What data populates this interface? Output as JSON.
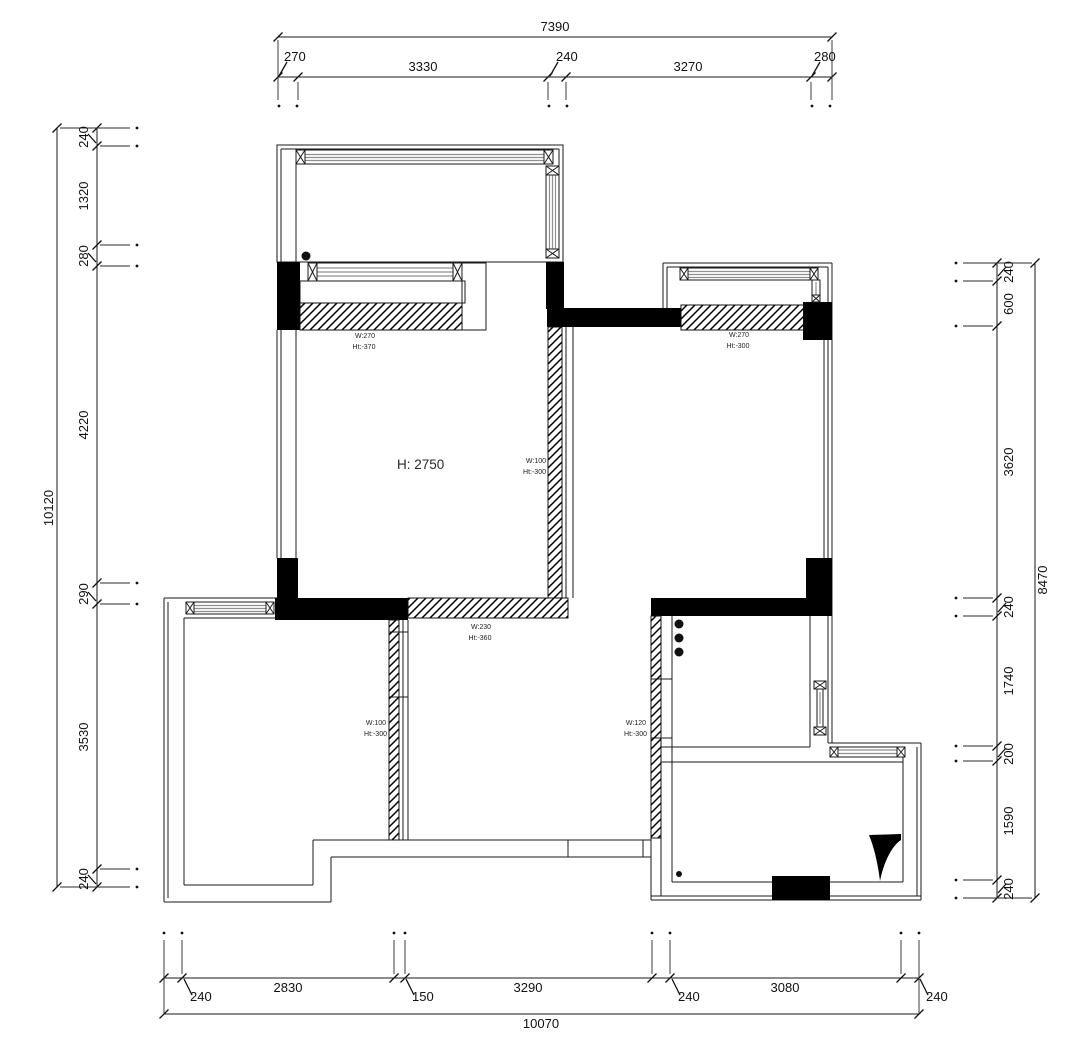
{
  "dimensions": {
    "top": {
      "overall": "7390",
      "segments": [
        "270",
        "3330",
        "240",
        "3270",
        "280"
      ]
    },
    "left": {
      "overall": "10120",
      "segments": [
        "240",
        "1320",
        "280",
        "4220",
        "290",
        "3530",
        "240"
      ]
    },
    "right": {
      "overall": "8470",
      "segments": [
        "240",
        "600",
        "3620",
        "240",
        "1740",
        "200",
        "1590",
        "240"
      ]
    },
    "bottom": {
      "overall": "10070",
      "segments": [
        "240",
        "2830",
        "150",
        "3290",
        "240",
        "3080",
        "240"
      ]
    }
  },
  "labels": {
    "room_height": "H: 2750",
    "wall_notes": [
      {
        "id": "bay-window-top-left",
        "w": "W:270",
        "h": "Ht:-370"
      },
      {
        "id": "wall-top-right",
        "w": "W:270",
        "h": "Ht:-300"
      },
      {
        "id": "wall-mid-vertical",
        "w": "W:100",
        "h": "Ht:-300"
      },
      {
        "id": "wall-mid-horizontal",
        "w": "W:230",
        "h": "Ht:-360"
      },
      {
        "id": "wall-left-vertical",
        "w": "W:100",
        "h": "Ht:-300"
      },
      {
        "id": "wall-kitchen-vertical",
        "w": "W:120",
        "h": "Ht:-300"
      }
    ]
  },
  "colors": {
    "line": "#1a1a1a",
    "window_band": "#8f8f8f",
    "solid_wall": "#000000",
    "background": "#ffffff",
    "note_text": "#222222"
  }
}
